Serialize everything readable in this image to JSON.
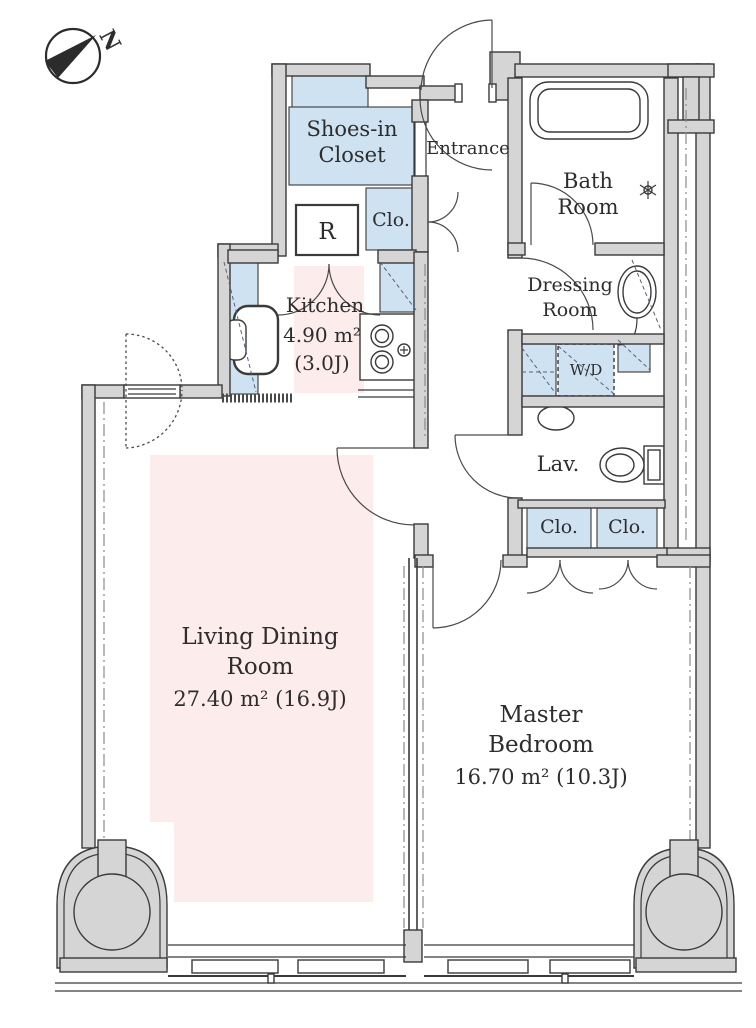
{
  "title": "Apartment floor plan",
  "compass": {
    "north_label": "N"
  },
  "colors": {
    "wall_gray": "#d5d5d5",
    "outline": "#3a3a3a",
    "closet_blue": "#cfe2f1",
    "highlight_pink": "#fdecec",
    "text": "#2d2d2d",
    "background": "#ffffff",
    "dash_accent": "#55617a"
  },
  "rooms": {
    "shoes_closet": {
      "line1": "Shoes-in",
      "line2": "Closet"
    },
    "entrance": {
      "label": "Entrance"
    },
    "bath_room": {
      "line1": "Bath",
      "line2": "Room"
    },
    "hall_closet": {
      "label": "Clo."
    },
    "refrigerator": {
      "label": "R"
    },
    "kitchen": {
      "label": "Kitchen",
      "area_m2": "4.90 m²",
      "area_jo": "(3.0J)"
    },
    "dressing_room": {
      "line1": "Dressing",
      "line2": "Room"
    },
    "washer_dryer": {
      "label": "W/D"
    },
    "lavatory": {
      "label": "Lav."
    },
    "bedroom_closet_left": {
      "label": "Clo."
    },
    "bedroom_closet_right": {
      "label": "Clo."
    },
    "living_dining": {
      "line1": "Living Dining",
      "line2": "Room",
      "area": "27.40 m² (16.9J)"
    },
    "master_bedroom": {
      "line1": "Master",
      "line2": "Bedroom",
      "area": "16.70 m² (10.3J)"
    }
  }
}
